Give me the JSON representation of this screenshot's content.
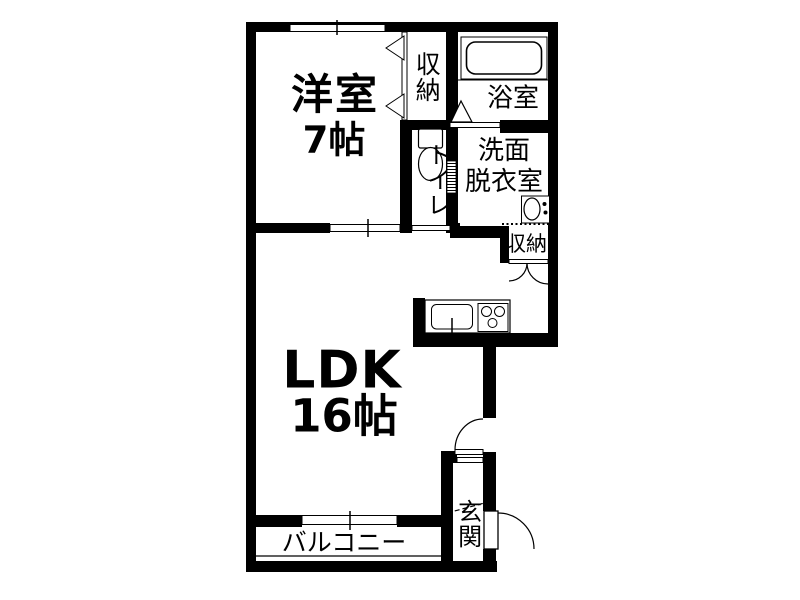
{
  "floorplan": {
    "background_color": "#ffffff",
    "line_color": "#000000",
    "rooms": {
      "bedroom": {
        "name": "洋室",
        "size": "7帖"
      },
      "closet": {
        "label": "収納"
      },
      "bathroom": {
        "label": "浴室"
      },
      "toilet": {
        "label": "トイレ"
      },
      "washroom": {
        "line1": "洗面",
        "line2": "脱衣室"
      },
      "storage": {
        "label": "収納"
      },
      "ldk": {
        "name": "LDK",
        "size": "16帖"
      },
      "balcony": {
        "label": "バルコニー"
      },
      "entrance": {
        "label": "玄関"
      }
    }
  }
}
